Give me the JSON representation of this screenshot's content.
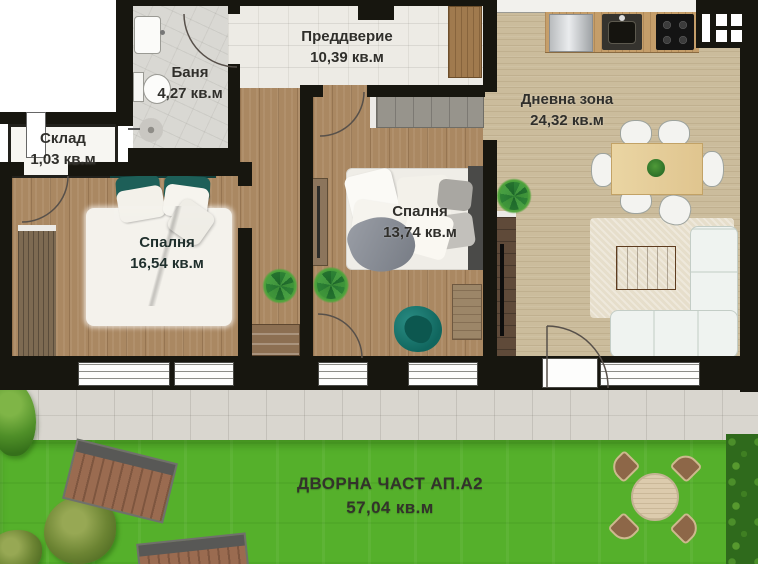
{
  "rooms": [
    {
      "id": "entry",
      "name": "Преддверие",
      "area": "10,39 кв.м"
    },
    {
      "id": "bathroom",
      "name": "Баня",
      "area": "4,27 кв.м"
    },
    {
      "id": "storage",
      "name": "Склад",
      "area": "1,03 кв.м"
    },
    {
      "id": "bedroom-1",
      "name": "Спалня",
      "area": "16,54 кв.м"
    },
    {
      "id": "bedroom-2",
      "name": "Спалня",
      "area": "13,74 кв.м"
    },
    {
      "id": "living",
      "name": "Дневна зона",
      "area": "24,32 кв.м"
    },
    {
      "id": "yard",
      "name": "ДВОРНА ЧАСТ АП.А2",
      "area": "57,04 кв.м"
    }
  ],
  "colors": {
    "wall": "#17160f",
    "bedroom_wood": "#aa8862",
    "living_wood": "#cbbc9c",
    "accent_teal": "#176a62",
    "grass_green": "#55b02b",
    "terrace_gray": "#d9d6cf"
  }
}
